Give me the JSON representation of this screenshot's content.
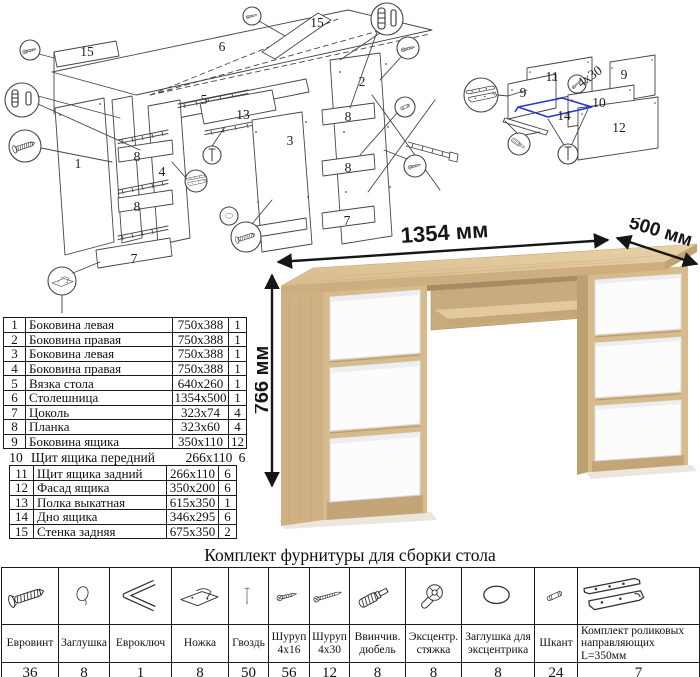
{
  "diagram": {
    "labels": [
      {
        "text": "15",
        "x": 87,
        "y": 56
      },
      {
        "text": "6",
        "x": 222,
        "y": 51
      },
      {
        "text": "15",
        "x": 317,
        "y": 27
      },
      {
        "text": "5",
        "x": 204,
        "y": 104
      },
      {
        "text": "1",
        "x": 78,
        "y": 168
      },
      {
        "text": "8",
        "x": 137,
        "y": 161
      },
      {
        "text": "4",
        "x": 162,
        "y": 176
      },
      {
        "text": "8",
        "x": 137,
        "y": 211
      },
      {
        "text": "7",
        "x": 134,
        "y": 263
      },
      {
        "text": "13",
        "x": 243,
        "y": 119
      },
      {
        "text": "3",
        "x": 290,
        "y": 145
      },
      {
        "text": "2",
        "x": 362,
        "y": 86
      },
      {
        "text": "8",
        "x": 348,
        "y": 121
      },
      {
        "text": "8",
        "x": 348,
        "y": 172
      },
      {
        "text": "7",
        "x": 347,
        "y": 225
      },
      {
        "text": "11",
        "x": 552,
        "y": 81
      },
      {
        "text": "9",
        "x": 523,
        "y": 97
      },
      {
        "text": "9",
        "x": 624,
        "y": 79
      },
      {
        "text": "10",
        "x": 599,
        "y": 107
      },
      {
        "text": "14",
        "x": 564,
        "y": 120
      },
      {
        "text": "12",
        "x": 619,
        "y": 132
      },
      {
        "text": "4x30",
        "x": 592,
        "y": 80,
        "rot": -35
      }
    ],
    "line_color": "#454545",
    "highlight_color": "#2438c8"
  },
  "parts_table": {
    "rows": [
      {
        "no": "1",
        "name": "Боковина левая",
        "size": "750x388",
        "qty": "1"
      },
      {
        "no": "2",
        "name": "Боковина правая",
        "size": "750x388",
        "qty": "1"
      },
      {
        "no": "3",
        "name": "Боковина левая",
        "size": "750x388",
        "qty": "1"
      },
      {
        "no": "4",
        "name": "Боковина правая",
        "size": "750x388",
        "qty": "1"
      },
      {
        "no": "5",
        "name": "Вязка стола",
        "size": "640x260",
        "qty": "1"
      },
      {
        "no": "6",
        "name": "Столешница",
        "size": "1354x500",
        "qty": "1"
      },
      {
        "no": "7",
        "name": "Цоколь",
        "size": "323x74",
        "qty": "4"
      },
      {
        "no": "8",
        "name": "Планка",
        "size": "323x60",
        "qty": "4"
      },
      {
        "no": "9",
        "name": "Боковина ящика",
        "size": "350x110",
        "qty": "12"
      },
      {
        "no": "10",
        "name": "Щит ящика передний",
        "size": "266x110",
        "qty": "6"
      },
      {
        "no": "11",
        "name": "Щит ящика задний",
        "size": "266x110",
        "qty": "6"
      },
      {
        "no": "12",
        "name": "Фасад ящика",
        "size": "350x200",
        "qty": "6"
      },
      {
        "no": "13",
        "name": "Полка выкатная",
        "size": "615x350",
        "qty": "1"
      },
      {
        "no": "14",
        "name": "Дно ящика",
        "size": "346x295",
        "qty": "6"
      },
      {
        "no": "15",
        "name": "Стенка задняя",
        "size": "675x350",
        "qty": "2"
      }
    ]
  },
  "desk": {
    "width_label": "1354 мм",
    "depth_label": "500 мм",
    "height_label": "766 мм",
    "colors": {
      "oak_top": "#e0c69a",
      "oak_front": "#d6b98b",
      "oak_side": "#cfb183",
      "oak_dark": "#a98e64",
      "drawer_white": "#fcfcfc"
    }
  },
  "hardware": {
    "title": "Комплект фурнитуры для сборки стола",
    "items": [
      {
        "name": "Евровинт",
        "qty": "36",
        "icon": "eurovint-icon"
      },
      {
        "name": "Заглушка",
        "qty": "8",
        "icon": "cap-icon"
      },
      {
        "name": "Евроключ",
        "qty": "1",
        "icon": "hex-key-icon"
      },
      {
        "name": "Ножка",
        "qty": "8",
        "icon": "foot-icon"
      },
      {
        "name": "Гвоздь",
        "qty": "50",
        "icon": "nail-icon"
      },
      {
        "name": "Шуруп 4x16",
        "qty": "56",
        "icon": "screw-short-icon"
      },
      {
        "name": "Шуруп 4x30",
        "qty": "12",
        "icon": "screw-long-icon"
      },
      {
        "name": "Ввинчив. дюбель",
        "qty": "8",
        "icon": "dowel-screw-icon"
      },
      {
        "name": "Эксцентр. стяжка",
        "qty": "8",
        "icon": "cam-lock-icon"
      },
      {
        "name": "Заглушка для эксцентрика",
        "qty": "8",
        "icon": "cam-cap-icon"
      },
      {
        "name": "Шкант",
        "qty": "24",
        "icon": "wood-dowel-icon"
      },
      {
        "name": "Комплект роликовых направляющих L=350мм",
        "qty": "7",
        "icon": "roller-slides-icon"
      }
    ]
  }
}
